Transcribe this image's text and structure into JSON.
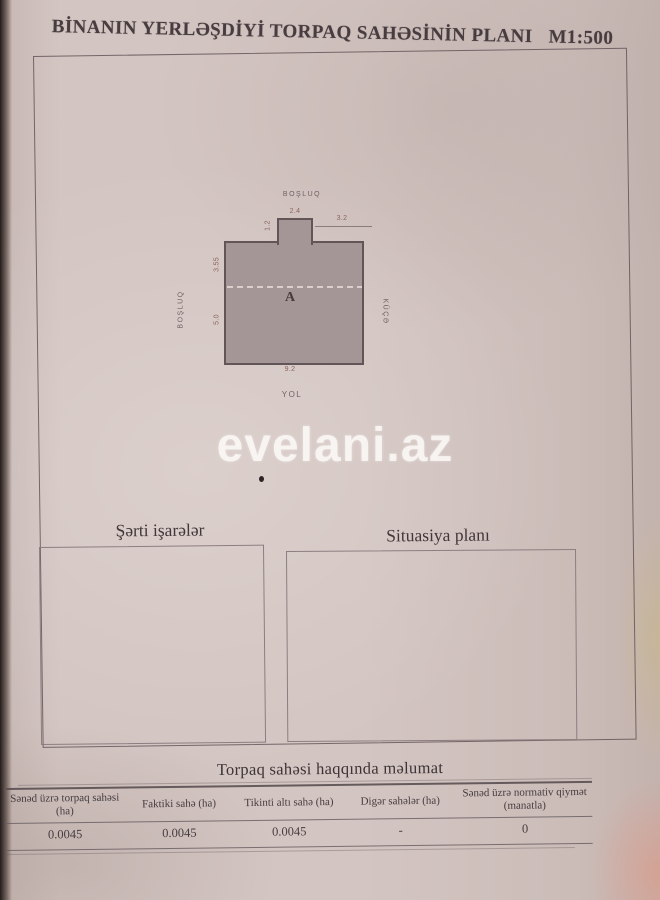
{
  "document": {
    "title": "BİNANIN YERLƏŞDİYİ TORPAQ SAHƏSİNİN PLANI",
    "scale": "M1:500",
    "watermark": "evelani.az"
  },
  "plan": {
    "area_label": "A",
    "surroundings": {
      "top": "BOŞLUQ",
      "left": "BOŞLUQ",
      "right": "KÜÇƏ",
      "bottom": "YOL"
    },
    "dimensions": {
      "annex_width": "2.4",
      "annex_height": "1.2",
      "top_right_offset": "3.2",
      "left_upper": "3.55",
      "left_lower": "5.0",
      "bottom_width": "9.2"
    }
  },
  "sections": {
    "legend_title": "Şərti işarələr",
    "situation_title": "Situasiya planı"
  },
  "info_table": {
    "title": "Torpaq sahəsi haqqında məlumat",
    "columns": [
      {
        "header": "Sənəd üzrə torpaq sahəsi (ha)",
        "value": "0.0045"
      },
      {
        "header": "Faktiki sahə (ha)",
        "value": "0.0045"
      },
      {
        "header": "Tikinti altı sahə (ha)",
        "value": "0.0045"
      },
      {
        "header": "Digər sahələr (ha)",
        "value": "-"
      },
      {
        "header": "Sənəd üzrə normativ qiymət (manatla)",
        "value": "0"
      }
    ]
  },
  "colors": {
    "paper": "#d3c5c1",
    "building_fill": "#a49596",
    "building_outline": "#615558",
    "ink": "#463c3f",
    "watermark_color": "#fdfaf7"
  }
}
